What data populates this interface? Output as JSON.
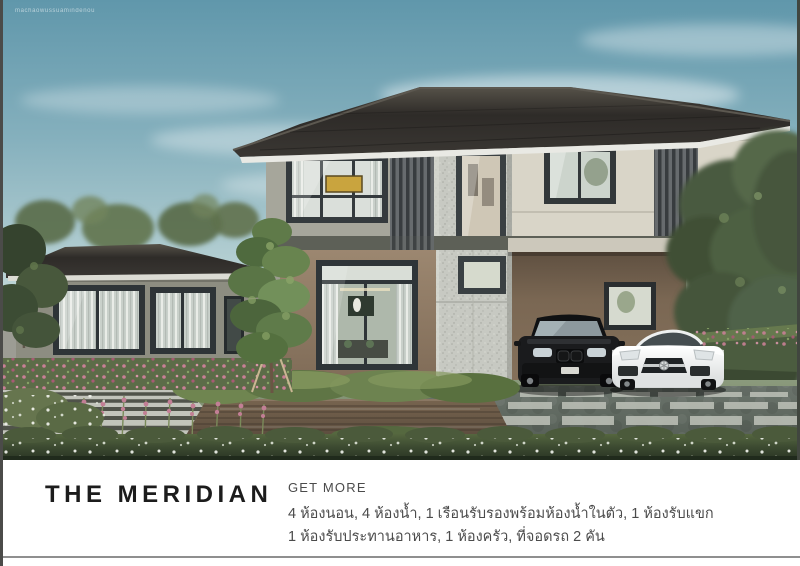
{
  "watermark": "machaowussuamindenou",
  "footer": {
    "title": "THE MERIDIAN",
    "tagline": "GET MORE",
    "spec_line1": "4 ห้องนอน, 4 ห้องน้ำ, 1 เรือนรับรองพร้อมห้องน้ำในตัว, 1 ห้องรับแขก",
    "spec_line2": "1 ห้องรับประทานอาหาร, 1 ห้องครัว, ที่จอดรถ 2 คัน"
  },
  "scene": {
    "subject": "two-storey modern house rendering with garden, wooden deck, stone walkway, black SUV and white sports car under carport",
    "colors": {
      "sky_top": "#6097ab",
      "sky_horizon": "#e7eeea",
      "roof": "#312e2a",
      "wall_gray_green": "#a6a69b",
      "wall_cream": "#d9d5c8",
      "wall_brown": "#97826c",
      "stone_column": "#c7c9c2",
      "hedge": "#47553c",
      "lawn": "#84936f",
      "deck_wood": "#6b5948",
      "flowers_pink": "#c07d92",
      "suv": "#1a1b1d",
      "sports_car": "#eef0f0"
    }
  }
}
